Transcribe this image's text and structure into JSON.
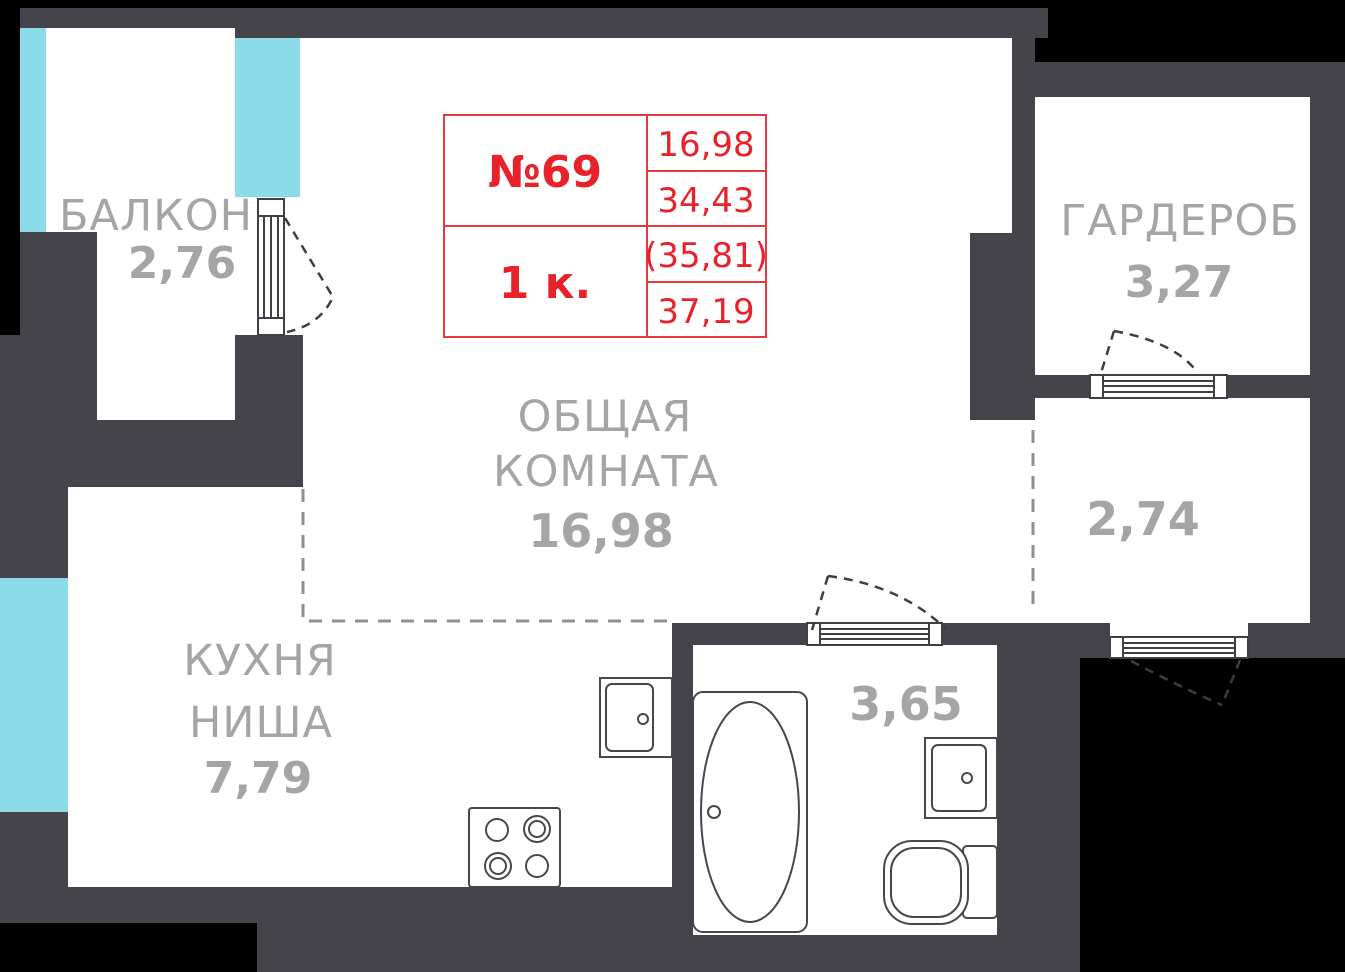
{
  "unit": {
    "number": "№69",
    "rooms_count": "1 к.",
    "areas": [
      "16,98",
      "34,43",
      "(35,81)",
      "37,19"
    ]
  },
  "rooms": {
    "balcony": {
      "name": "БАЛКОН",
      "area": "2,76"
    },
    "wardrobe": {
      "name": "ГАРДЕРОБ",
      "area": "3,27"
    },
    "living": {
      "line1": "ОБЩАЯ",
      "line2": "КОМНАТА",
      "area": "16,98"
    },
    "kitchen": {
      "line1": "КУХНЯ",
      "line2": "НИША",
      "area": "7,79"
    },
    "bathroom": {
      "area": "3,65"
    },
    "hall": {
      "area": "2,74"
    }
  },
  "colors": {
    "outside": "#000000",
    "wall": "#45444a",
    "window": "#8bdbe8",
    "label_gray": "#a5a5a6",
    "red_text": "#e8222b",
    "red_line": "#e6383e"
  }
}
